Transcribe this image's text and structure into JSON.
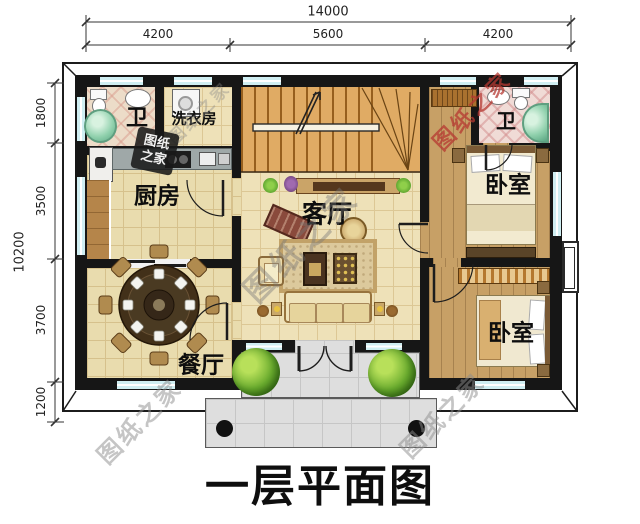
{
  "title": "一层平面图",
  "watermark": {
    "text": "图纸之家",
    "stamp_line1": "图纸",
    "stamp_line2": "之家"
  },
  "dimensions": {
    "width_total": "14000",
    "width_segments": [
      "4200",
      "5600",
      "4200"
    ],
    "height_total": "10200",
    "height_segments": [
      "1800",
      "3500",
      "3700",
      "1200"
    ]
  },
  "rooms": {
    "bathroom_top_left": "卫",
    "laundry": "洗衣房",
    "kitchen": "厨房",
    "dining": "餐厅",
    "living": "客厅",
    "bathroom_top_right": "卫",
    "bedroom_top": "卧室",
    "bedroom_bottom": "卧室"
  },
  "colors": {
    "wall": "#161616",
    "tile_floor": "#e9dcae",
    "wood_floor": "#c7a066",
    "window": "#cfeef2",
    "stairs": "#e0ab64",
    "porch": "#dedede",
    "bathtub": "#7fc8a0",
    "watermark_red": "#b43a32"
  }
}
